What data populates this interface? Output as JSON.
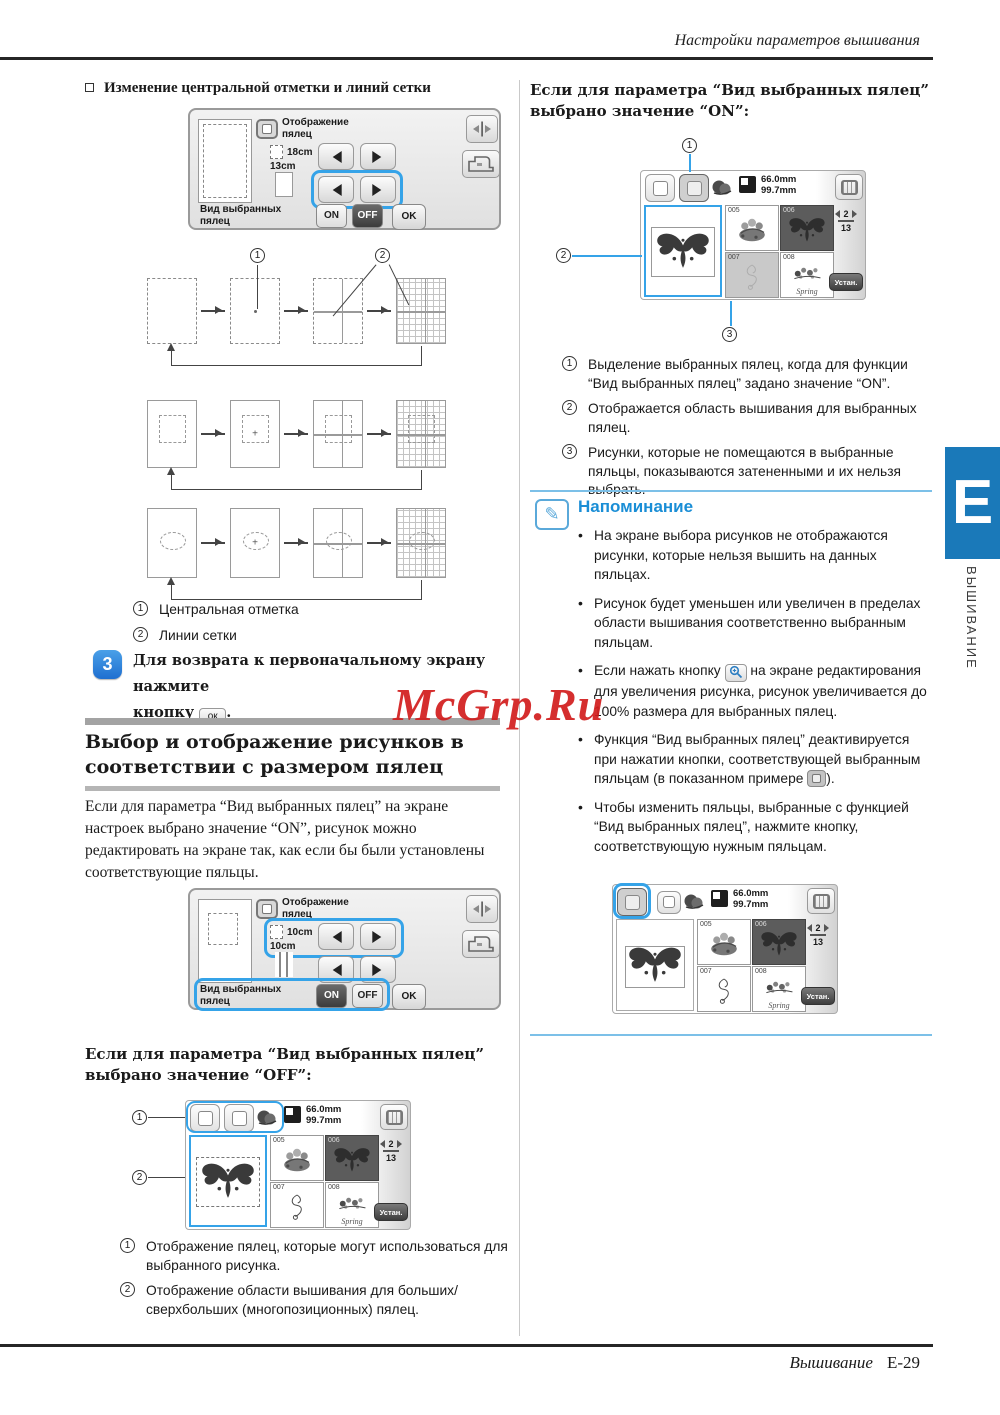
{
  "page": {
    "header_title": "Настройки параметров вышивания",
    "footer_section": "Вышивание",
    "footer_page": "E-29",
    "tab_letter": "E",
    "tab_side_text": "ВЫШИВАНИЕ",
    "watermark": "McGrp.Ru"
  },
  "colors": {
    "accent_blue": "#35a3e8",
    "tab_blue": "#1a79b9",
    "memo_blue": "#1a8ed6",
    "watermark_red": "#d21d1d"
  },
  "icons": {
    "memo_pencil": "✎"
  },
  "screen_common": {
    "display_label": "Отображение пялец",
    "hoop_view_label": "Вид выбранных пялец",
    "on_label": "ON",
    "off_label": "OFF",
    "ok_label": "OK"
  },
  "left": {
    "topic_title": "Изменение центральной отметки и линий сетки",
    "screen1": {
      "size_top": "18cm",
      "size_bottom": "13cm"
    },
    "screen2": {
      "size_top": "10cm",
      "size_bottom": "10cm"
    },
    "diagram_legend": [
      {
        "num": "1",
        "text": "Центральная отметка"
      },
      {
        "num": "2",
        "text": "Линии сетки"
      }
    ],
    "step": {
      "number": "3",
      "line1": "Для возврата к первоначальному экрану нажмите",
      "line2_before": "кнопку",
      "ok_button": "ок",
      "line2_after": "."
    },
    "section_title_line1": "Выбор и отображение рисунков в",
    "section_title_line2": "соответствии с размером пялец",
    "paragraph": "Если для параметра “Вид выбранных пялец” на экране настроек выбрано значение “ON”, рисунок можно редактировать на экране так, как если бы были установлены соответствующие пяльцы.",
    "off_heading": "Если для параметра “Вид выбранных пялец” выбрано значение “OFF”:",
    "off_legend": [
      {
        "num": "1",
        "text": "Отображение пялец, которые могут использоваться для выбранного рисунка."
      },
      {
        "num": "2",
        "text": "Отображение области вышивания для больших/сверхбольших (многопозиционных) пялец."
      }
    ]
  },
  "right": {
    "on_heading": "Если для параметра “Вид выбранных пялец” выбрано значение “ON”:",
    "on_legend": [
      {
        "num": "1",
        "text": "Выделение выбранных пялец, когда для функции “Вид выбранных пялец” задано значение “ON”."
      },
      {
        "num": "2",
        "text": "Отображается область вышивания для выбранных пялец."
      },
      {
        "num": "3",
        "text": "Рисунки, которые не помещаются в выбранные пяльцы, показываются затененными и их нельзя выбрать."
      }
    ],
    "memo": {
      "title": "Напоминание",
      "bullet1": "На экране выбора рисунков не отображаются рисунки, которые нельзя вышить на данных пяльцах.",
      "bullet2": "Рисунок будет уменьшен или увеличен в пределах области вышивания соответственно выбранным пяльцам.",
      "bullet3_before": "Если нажать кнопку",
      "bullet3_after": "на экране редактирования для увеличения рисунка, рисунок увеличивается до 100% размера для выбранных пялец.",
      "bullet4_before": "Функция “Вид выбранных пялец” деактивируется при нажатии кнопки, соответствующей выбранным пяльцам (в показанном примере",
      "bullet4_after": ").",
      "bullet5": "Чтобы изменить пяльцы, выбранные с функцией “Вид выбранных пялец”, нажмите кнопку, соответствующую нужным пяльцам."
    }
  },
  "pattern_screen": {
    "size_width": "66.0mm",
    "size_height": "99.7mm",
    "page_current": "2",
    "page_total": "13",
    "cells": [
      {
        "id": "005"
      },
      {
        "id": "006"
      },
      {
        "id": "007"
      },
      {
        "id": "008"
      }
    ],
    "spring_label": "Spring",
    "set_button": "Устан."
  }
}
